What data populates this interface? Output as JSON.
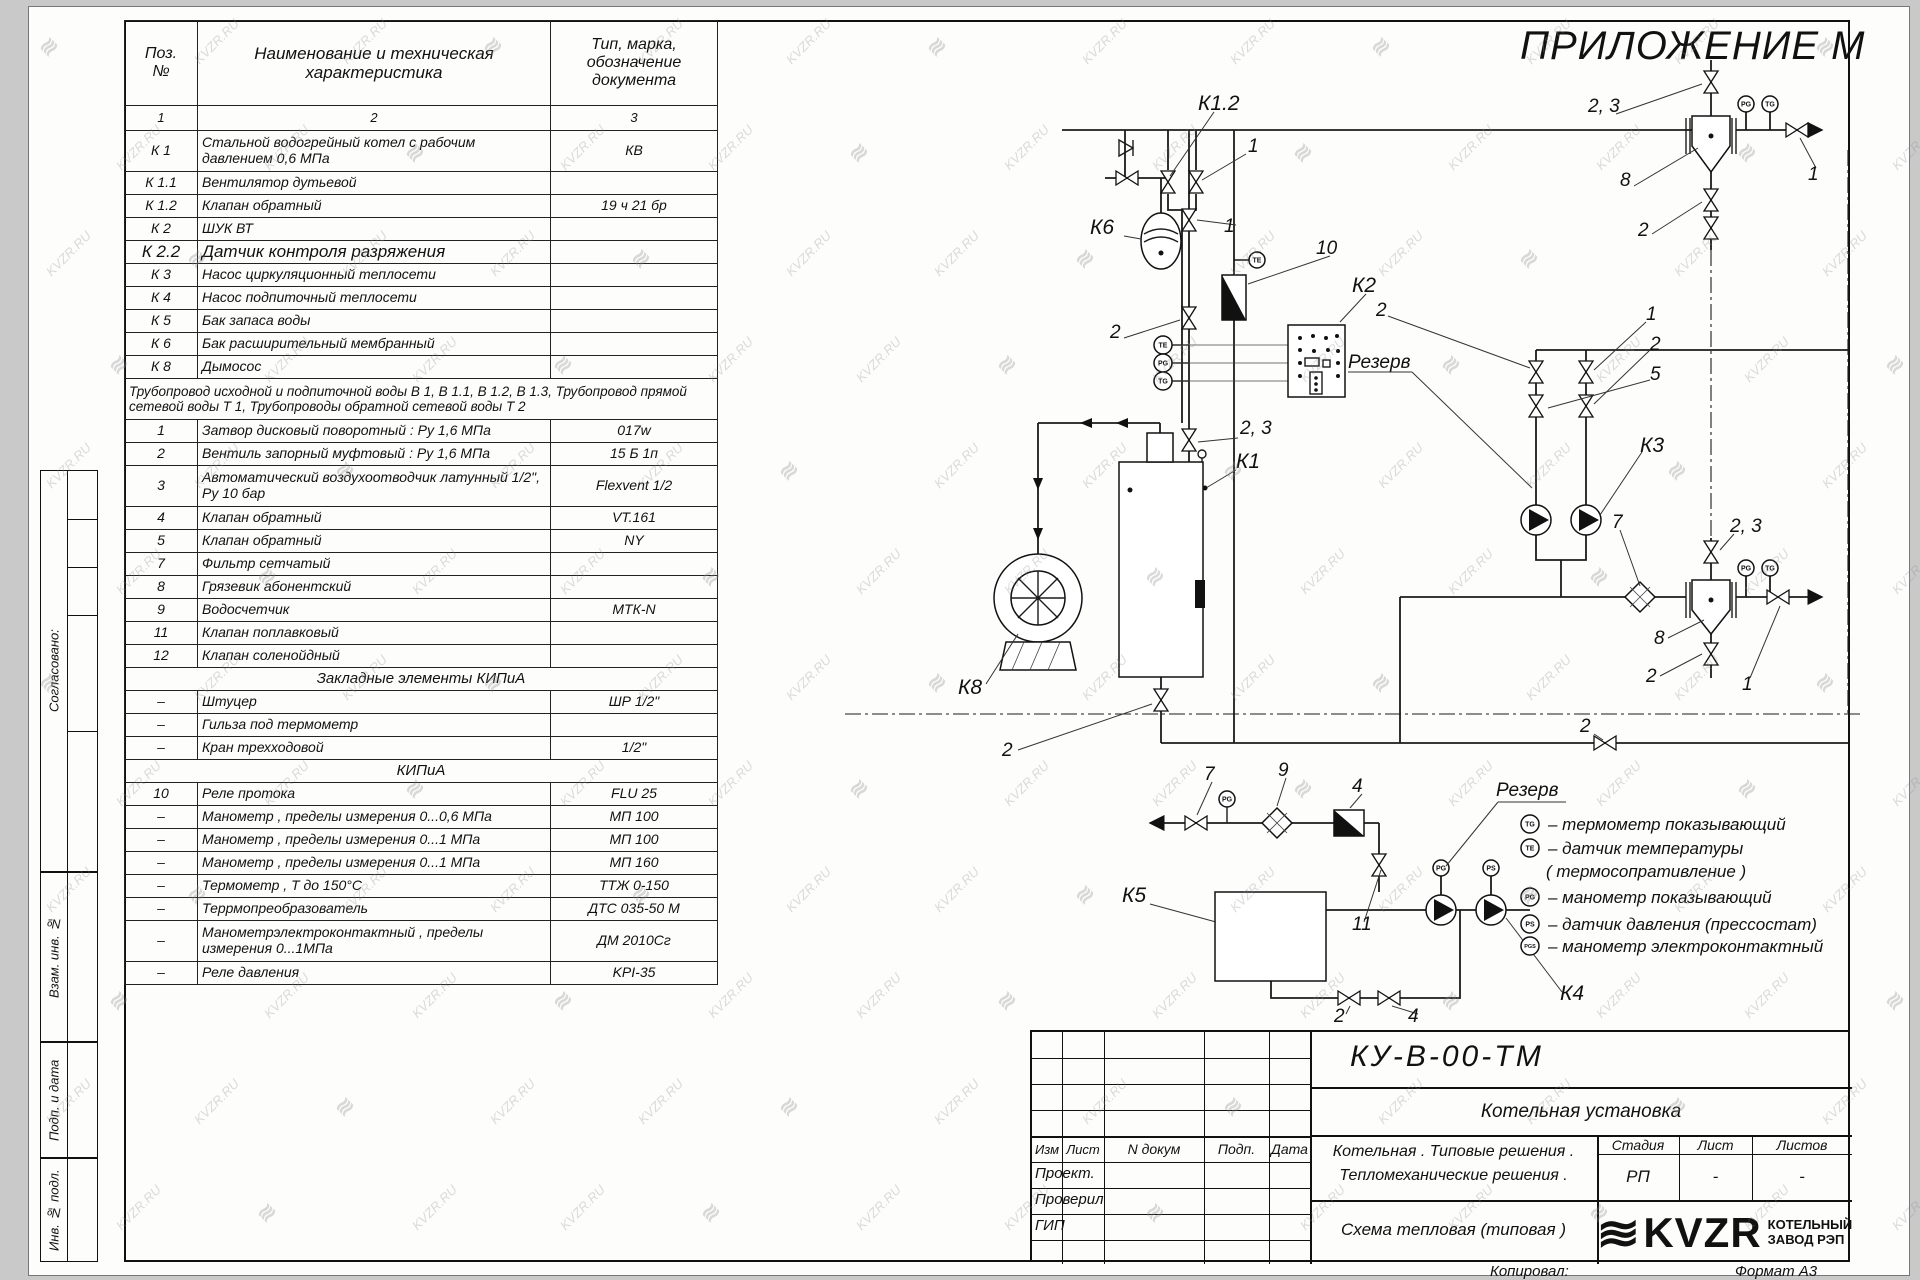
{
  "watermark": {
    "text": "KVZR.RU",
    "logo_glyph": "≋"
  },
  "sheet": {
    "appendix_title": "ПРИЛОЖЕНИЕ М",
    "copied_label": "Копировал:",
    "format_note": "Формат А3"
  },
  "side_strip": {
    "agreed": "Согласовано:",
    "vzam": "Взам. инв. №",
    "podp": "Подп. и дата",
    "inv": "Инв. № подл."
  },
  "spec_table": {
    "col_headers": [
      "Поз.\n№",
      "Наименование и техническая характеристика",
      "Тип, марка, обозначение документа"
    ],
    "col_numbers": [
      "1",
      "2",
      "3"
    ],
    "rows": [
      {
        "pos": "К 1",
        "name": "Стальной водогрейный котел с рабочим давлением 0,6  МПа",
        "type": "КВ",
        "tall": true
      },
      {
        "pos": "К 1.1",
        "name": "Вентилятор дутьевой",
        "type": ""
      },
      {
        "pos": "К 1.2",
        "name": "Клапан обратный",
        "type": "19 ч 21 бр"
      },
      {
        "pos": "К 2",
        "name": "ШУК ВТ",
        "type": ""
      },
      {
        "pos": "К 2.2",
        "name": "Датчик контроля разряжения",
        "type": "",
        "style": "big"
      },
      {
        "pos": "К 3",
        "name": "Насос циркуляционный теплосети",
        "type": ""
      },
      {
        "pos": "К 4",
        "name": "Насос подпиточный теплосети",
        "type": ""
      },
      {
        "pos": "К 5",
        "name": "Бак запаса воды",
        "type": ""
      },
      {
        "pos": "К 6",
        "name": "Бак расширительный мембранный",
        "type": ""
      },
      {
        "pos": "К 8",
        "name": "Дымосос",
        "type": ""
      },
      {
        "kind": "note",
        "name": "Трубопровод исходной и подпиточной воды В 1,   В 1.1,   В 1.2, В 1.3,  Трубопровод прямой сетевой воды Т 1,  Трубопроводы обратной сетевой воды Т 2",
        "tall": true
      },
      {
        "pos": "1",
        "name": "Затвор дисковый поворотный :  Ру 1,6  МПа",
        "type": "017w"
      },
      {
        "pos": "2",
        "name": "Вентиль запорный муфтовый :  Ру 1,6  МПа",
        "type": "15 Б 1п"
      },
      {
        "pos": "3",
        "name": "Автоматический воздухоотводчик  латунный 1/2\",  Ру 10 бар",
        "type": "Flexvent 1/2",
        "tall": true
      },
      {
        "pos": "4",
        "name": "Клапан обратный",
        "type": "VT.161"
      },
      {
        "pos": "5",
        "name": "Клапан обратный",
        "type": "NY"
      },
      {
        "pos": "7",
        "name": "Фильтр сетчатый",
        "type": ""
      },
      {
        "pos": "8",
        "name": "Грязевик абонентский",
        "type": ""
      },
      {
        "pos": "9",
        "name": "Водосчетчик",
        "type": "МТК-N"
      },
      {
        "pos": "11",
        "name": "Клапан поплавковый",
        "type": ""
      },
      {
        "pos": "12",
        "name": "Клапан соленойдный",
        "type": ""
      },
      {
        "kind": "section",
        "name": "Закладные элементы КИПиА"
      },
      {
        "pos": "–",
        "name": "Штуцер",
        "type": "ШР  1/2\""
      },
      {
        "pos": "–",
        "name": "Гильза под термометр",
        "type": ""
      },
      {
        "pos": "–",
        "name": "Кран трехходовой",
        "type": "1/2\""
      },
      {
        "kind": "section",
        "name": "КИПиА"
      },
      {
        "pos": "10",
        "name": "Реле протока",
        "type": "FLU 25"
      },
      {
        "pos": "–",
        "name": "Манометр , пределы измерения  0...0,6 МПа",
        "type": "МП 100"
      },
      {
        "pos": "–",
        "name": "Манометр , пределы измерения  0...1 МПа",
        "type": "МП 100"
      },
      {
        "pos": "–",
        "name": "Манометр , пределы измерения  0...1 МПа",
        "type": "МП 160"
      },
      {
        "pos": "–",
        "name": "Термометр , Т до 150°С",
        "type": "ТТЖ  0-150"
      },
      {
        "pos": "–",
        "name": "Террмопреобразователь",
        "type": "ДТС 035-50 М"
      },
      {
        "pos": "–",
        "name": "Манометрэлектроконтактный , пределы измерения 0...1МПа",
        "type": "ДМ 2010Сг",
        "tall": true
      },
      {
        "pos": "–",
        "name": "Реле давления",
        "type": "KPI-35"
      }
    ]
  },
  "diagram": {
    "labels": {
      "k1": "К1",
      "k12": "К1.2",
      "k2": "К2",
      "k3": "К3",
      "k4": "К4",
      "k5": "К5",
      "k6": "К6",
      "k8": "К8",
      "n1": "1",
      "n2": "2",
      "n4": "4",
      "n5": "5",
      "n7": "7",
      "n8": "8",
      "n9": "9",
      "n10": "10",
      "n11": "11",
      "n23": "2, 3",
      "reserve": "Резерв"
    }
  },
  "legend": {
    "title": "Резерв",
    "items": [
      {
        "code": "TG",
        "text": "– термометр показывающий"
      },
      {
        "code": "TE",
        "text": "– датчик температуры"
      },
      {
        "code": "",
        "text": "( термосопративление )"
      },
      {
        "code": "PG",
        "text": "– манометр показывающий"
      },
      {
        "code": "PS",
        "text": "– датчик давления (прессостат)"
      },
      {
        "code": "PGS",
        "text": "– манометр электроконтактный"
      }
    ]
  },
  "title_block": {
    "doc_number": "КУ-В-00-ТМ",
    "object_name": "Котельная установка",
    "desc_line1": "Котельная . Типовые решения .",
    "desc_line2": "Тепломеханические решения .",
    "scheme_name": "Схема тепловая  (типовая )",
    "stage_label": "Стадия",
    "sheet_label": "Лист",
    "sheets_label": "Листов",
    "stage": "РП",
    "sheet": "-",
    "sheets": "-",
    "header_cols": [
      "Изм",
      "Лист",
      "N докум",
      "Подп.",
      "Дата"
    ],
    "roles": [
      "Проект.",
      "Проверил",
      "ГИП"
    ],
    "logo_word": "KVZR",
    "company_line1": "КОТЕЛЬНЫЙ",
    "company_line2": "ЗАВОД РЭП"
  }
}
